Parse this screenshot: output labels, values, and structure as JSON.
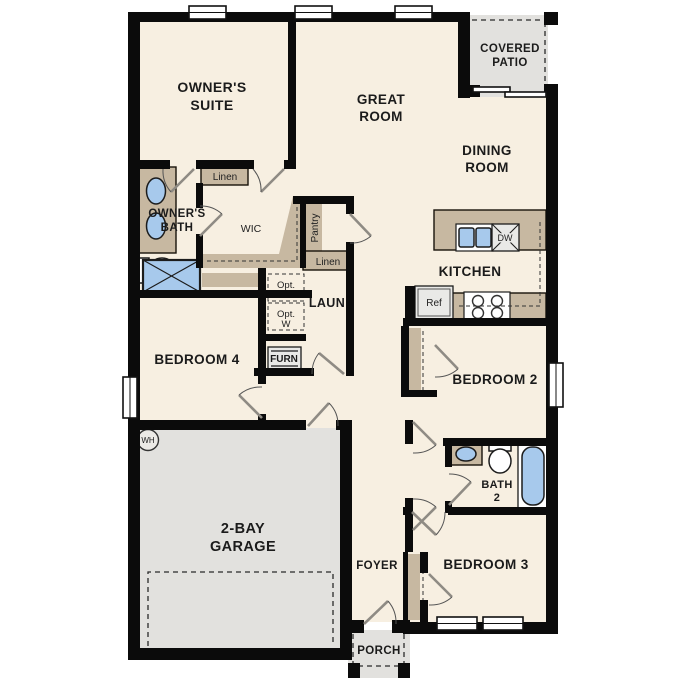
{
  "plan": {
    "rooms": {
      "owners_suite": {
        "lines": [
          "OWNER'S",
          "SUITE"
        ]
      },
      "great_room": {
        "lines": [
          "GREAT",
          "ROOM"
        ]
      },
      "covered_patio": {
        "lines": [
          "COVERED",
          "PATIO"
        ]
      },
      "dining_room": {
        "lines": [
          "DINING",
          "ROOM"
        ]
      },
      "owners_bath": {
        "lines": [
          "OWNER'S",
          "BATH"
        ]
      },
      "wic": {
        "label": "WIC"
      },
      "kitchen": {
        "label": "KITCHEN"
      },
      "laundry": {
        "label": "LAUN"
      },
      "bedroom4": {
        "label": "BEDROOM 4"
      },
      "bedroom2": {
        "label": "BEDROOM 2"
      },
      "bath2": {
        "lines": [
          "BATH",
          "2"
        ]
      },
      "bedroom3": {
        "label": "BEDROOM 3"
      },
      "garage": {
        "lines": [
          "2-BAY",
          "GARAGE"
        ]
      },
      "foyer": {
        "label": "FOYER"
      },
      "porch": {
        "label": "PORCH"
      }
    },
    "closets": {
      "linen_top": "Linen",
      "linen_hall": "Linen",
      "pantry": "Pantry"
    },
    "equipment": {
      "opt_dryer": {
        "lines": [
          "Opt.",
          "D"
        ]
      },
      "opt_washer": {
        "lines": [
          "Opt.",
          "W"
        ]
      },
      "furnace": "FURN",
      "water_heater": "WH",
      "refrigerator": "Ref",
      "dishwasher": "DW"
    },
    "colors": {
      "floor": "#f7efe1",
      "wall": "#0b0b0b",
      "casework_tan": "#c7b8a1",
      "concrete_gray": "#e2e1de",
      "fixture_blue": "#a7c9ec"
    }
  }
}
